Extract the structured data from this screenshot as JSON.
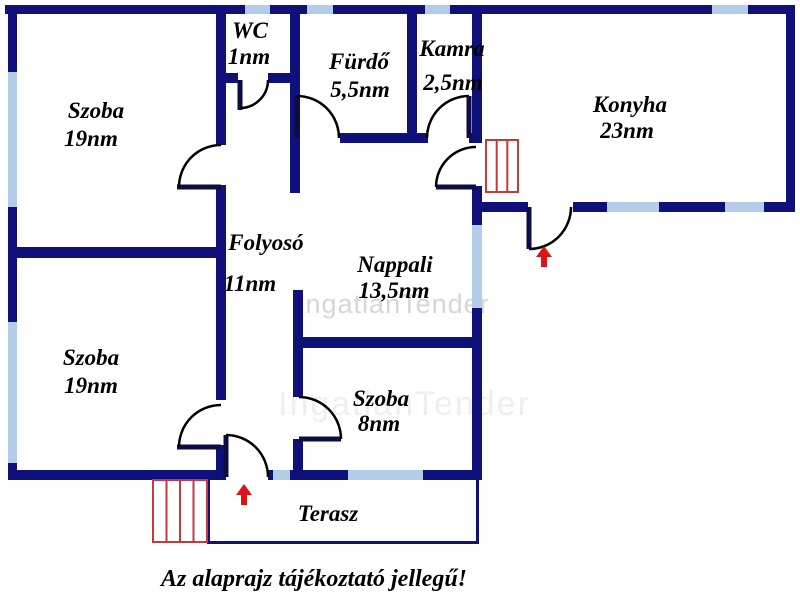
{
  "caption": "Az alaprajz tájékoztató jellegű!",
  "watermark": {
    "text": "IngatlanTender"
  },
  "rooms": {
    "wc": {
      "name": "WC",
      "area": "1nm"
    },
    "furdo": {
      "name": "Fürdő",
      "area": "5,5nm"
    },
    "kamra": {
      "name": "Kamra",
      "area": "2,5nm"
    },
    "konyha": {
      "name": "Konyha",
      "area": "23nm"
    },
    "szoba_top_left": {
      "name": "Szoba",
      "area": "19nm"
    },
    "folyoso": {
      "name": "Folyosó",
      "area": "11nm"
    },
    "nappali": {
      "name": "Nappali",
      "area": "13,5nm"
    },
    "szoba_bottom_left": {
      "name": "Szoba",
      "area": "19nm"
    },
    "szoba_small": {
      "name": "Szoba",
      "area": "8nm"
    },
    "terasz": {
      "name": "Terasz"
    }
  },
  "colors": {
    "wall": "#10107a",
    "window": "#b3cde8",
    "stairs_red": "#c23b3b",
    "arrow_red": "#dd1414",
    "label": "#000000",
    "watermark": "#d6d6da",
    "background": "#ffffff"
  }
}
